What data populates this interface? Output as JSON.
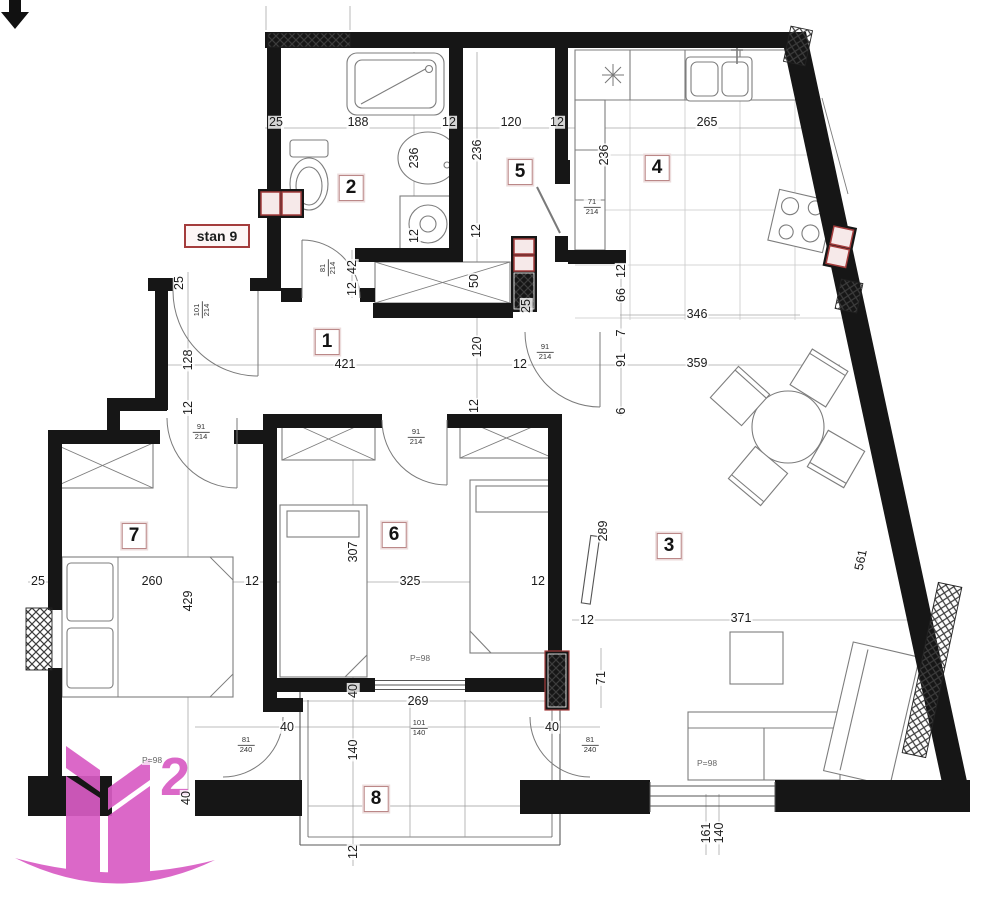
{
  "plan": {
    "unit_label": "stan 9",
    "logo_text": "2",
    "colors": {
      "accent_red": "#a43c3c",
      "logo_pink": "#d95cc4",
      "wall": "#161616"
    },
    "room_labels": [
      {
        "n": "1",
        "x": 327,
        "y": 342
      },
      {
        "n": "2",
        "x": 351,
        "y": 188
      },
      {
        "n": "3",
        "x": 669,
        "y": 546
      },
      {
        "n": "4",
        "x": 657,
        "y": 168
      },
      {
        "n": "5",
        "x": 520,
        "y": 172
      },
      {
        "n": "6",
        "x": 394,
        "y": 535
      },
      {
        "n": "7",
        "x": 134,
        "y": 536
      },
      {
        "n": "8",
        "x": 376,
        "y": 799
      }
    ],
    "dimension_labels": [
      {
        "t": "25",
        "x": 276,
        "y": 122
      },
      {
        "t": "188",
        "x": 358,
        "y": 122
      },
      {
        "t": "12",
        "x": 449,
        "y": 122
      },
      {
        "t": "120",
        "x": 511,
        "y": 122
      },
      {
        "t": "12",
        "x": 557,
        "y": 122
      },
      {
        "t": "265",
        "x": 707,
        "y": 122
      },
      {
        "t": "236",
        "x": 414,
        "y": 158,
        "v": 1
      },
      {
        "t": "236",
        "x": 477,
        "y": 150,
        "v": 1
      },
      {
        "t": "236",
        "x": 604,
        "y": 155,
        "v": 1
      },
      {
        "t": "12",
        "x": 414,
        "y": 236,
        "v": 1
      },
      {
        "t": "12",
        "x": 476,
        "y": 231,
        "v": 1
      },
      {
        "t": "25",
        "x": 179,
        "y": 283,
        "v": 1
      },
      {
        "t": "128",
        "x": 188,
        "y": 360,
        "v": 1
      },
      {
        "t": "12",
        "x": 188,
        "y": 408,
        "v": 1
      },
      {
        "t": "42",
        "x": 352,
        "y": 267,
        "v": 1
      },
      {
        "t": "12",
        "x": 352,
        "y": 289,
        "v": 1
      },
      {
        "t": "50",
        "x": 474,
        "y": 281,
        "v": 1
      },
      {
        "t": "120",
        "x": 477,
        "y": 347,
        "v": 1
      },
      {
        "t": "12",
        "x": 474,
        "y": 406,
        "v": 1
      },
      {
        "t": "25",
        "x": 526,
        "y": 306,
        "v": 1
      },
      {
        "t": "12",
        "x": 621,
        "y": 271,
        "v": 1
      },
      {
        "t": "66",
        "x": 621,
        "y": 295,
        "v": 1
      },
      {
        "t": "7",
        "x": 621,
        "y": 333,
        "v": 1
      },
      {
        "t": "91",
        "x": 621,
        "y": 360,
        "v": 1
      },
      {
        "t": "6",
        "x": 621,
        "y": 411,
        "v": 1
      },
      {
        "t": "346",
        "x": 697,
        "y": 314
      },
      {
        "t": "421",
        "x": 345,
        "y": 364
      },
      {
        "t": "359",
        "x": 697,
        "y": 363
      },
      {
        "t": "12",
        "x": 520,
        "y": 364
      },
      {
        "t": "25",
        "x": 38,
        "y": 581
      },
      {
        "t": "260",
        "x": 152,
        "y": 581
      },
      {
        "t": "12",
        "x": 252,
        "y": 581
      },
      {
        "t": "325",
        "x": 410,
        "y": 581
      },
      {
        "t": "12",
        "x": 538,
        "y": 581
      },
      {
        "t": "307",
        "x": 353,
        "y": 552,
        "v": 1
      },
      {
        "t": "429",
        "x": 188,
        "y": 601,
        "v": 1
      },
      {
        "t": "289",
        "x": 603,
        "y": 531,
        "v": 1
      },
      {
        "t": "12",
        "x": 587,
        "y": 620
      },
      {
        "t": "371",
        "x": 741,
        "y": 618
      },
      {
        "t": "71",
        "x": 601,
        "y": 678,
        "v": 1
      },
      {
        "t": "40",
        "x": 353,
        "y": 691,
        "v": 1
      },
      {
        "t": "140",
        "x": 353,
        "y": 750,
        "v": 1
      },
      {
        "t": "12",
        "x": 353,
        "y": 852,
        "v": 1
      },
      {
        "t": "269",
        "x": 418,
        "y": 701
      },
      {
        "t": "40",
        "x": 287,
        "y": 727
      },
      {
        "t": "40",
        "x": 552,
        "y": 727
      },
      {
        "t": "40",
        "x": 186,
        "y": 798,
        "v": 1
      },
      {
        "t": "161",
        "x": 706,
        "y": 833,
        "v": 1
      },
      {
        "t": "140",
        "x": 719,
        "y": 833,
        "v": 1
      },
      {
        "t": "561",
        "x": 861,
        "y": 560,
        "rot": -78
      }
    ],
    "door_size_labels": [
      {
        "w": "81",
        "h": "214",
        "x": 328,
        "y": 268,
        "v": 1
      },
      {
        "w": "101",
        "h": "214",
        "x": 202,
        "y": 310,
        "v": 1
      },
      {
        "w": "71",
        "h": "214",
        "x": 592,
        "y": 207
      },
      {
        "w": "91",
        "h": "214",
        "x": 545,
        "y": 352
      },
      {
        "w": "91",
        "h": "214",
        "x": 416,
        "y": 437
      },
      {
        "w": "91",
        "h": "214",
        "x": 201,
        "y": 432
      },
      {
        "w": "81",
        "h": "240",
        "x": 246,
        "y": 745
      },
      {
        "w": "81",
        "h": "240",
        "x": 590,
        "y": 745
      },
      {
        "w": "101",
        "h": "140",
        "x": 419,
        "y": 728
      }
    ],
    "area_labels": [
      {
        "t": "P=98",
        "x": 152,
        "y": 760
      },
      {
        "t": "P=98",
        "x": 420,
        "y": 658
      },
      {
        "t": "P=98",
        "x": 707,
        "y": 763
      }
    ]
  }
}
